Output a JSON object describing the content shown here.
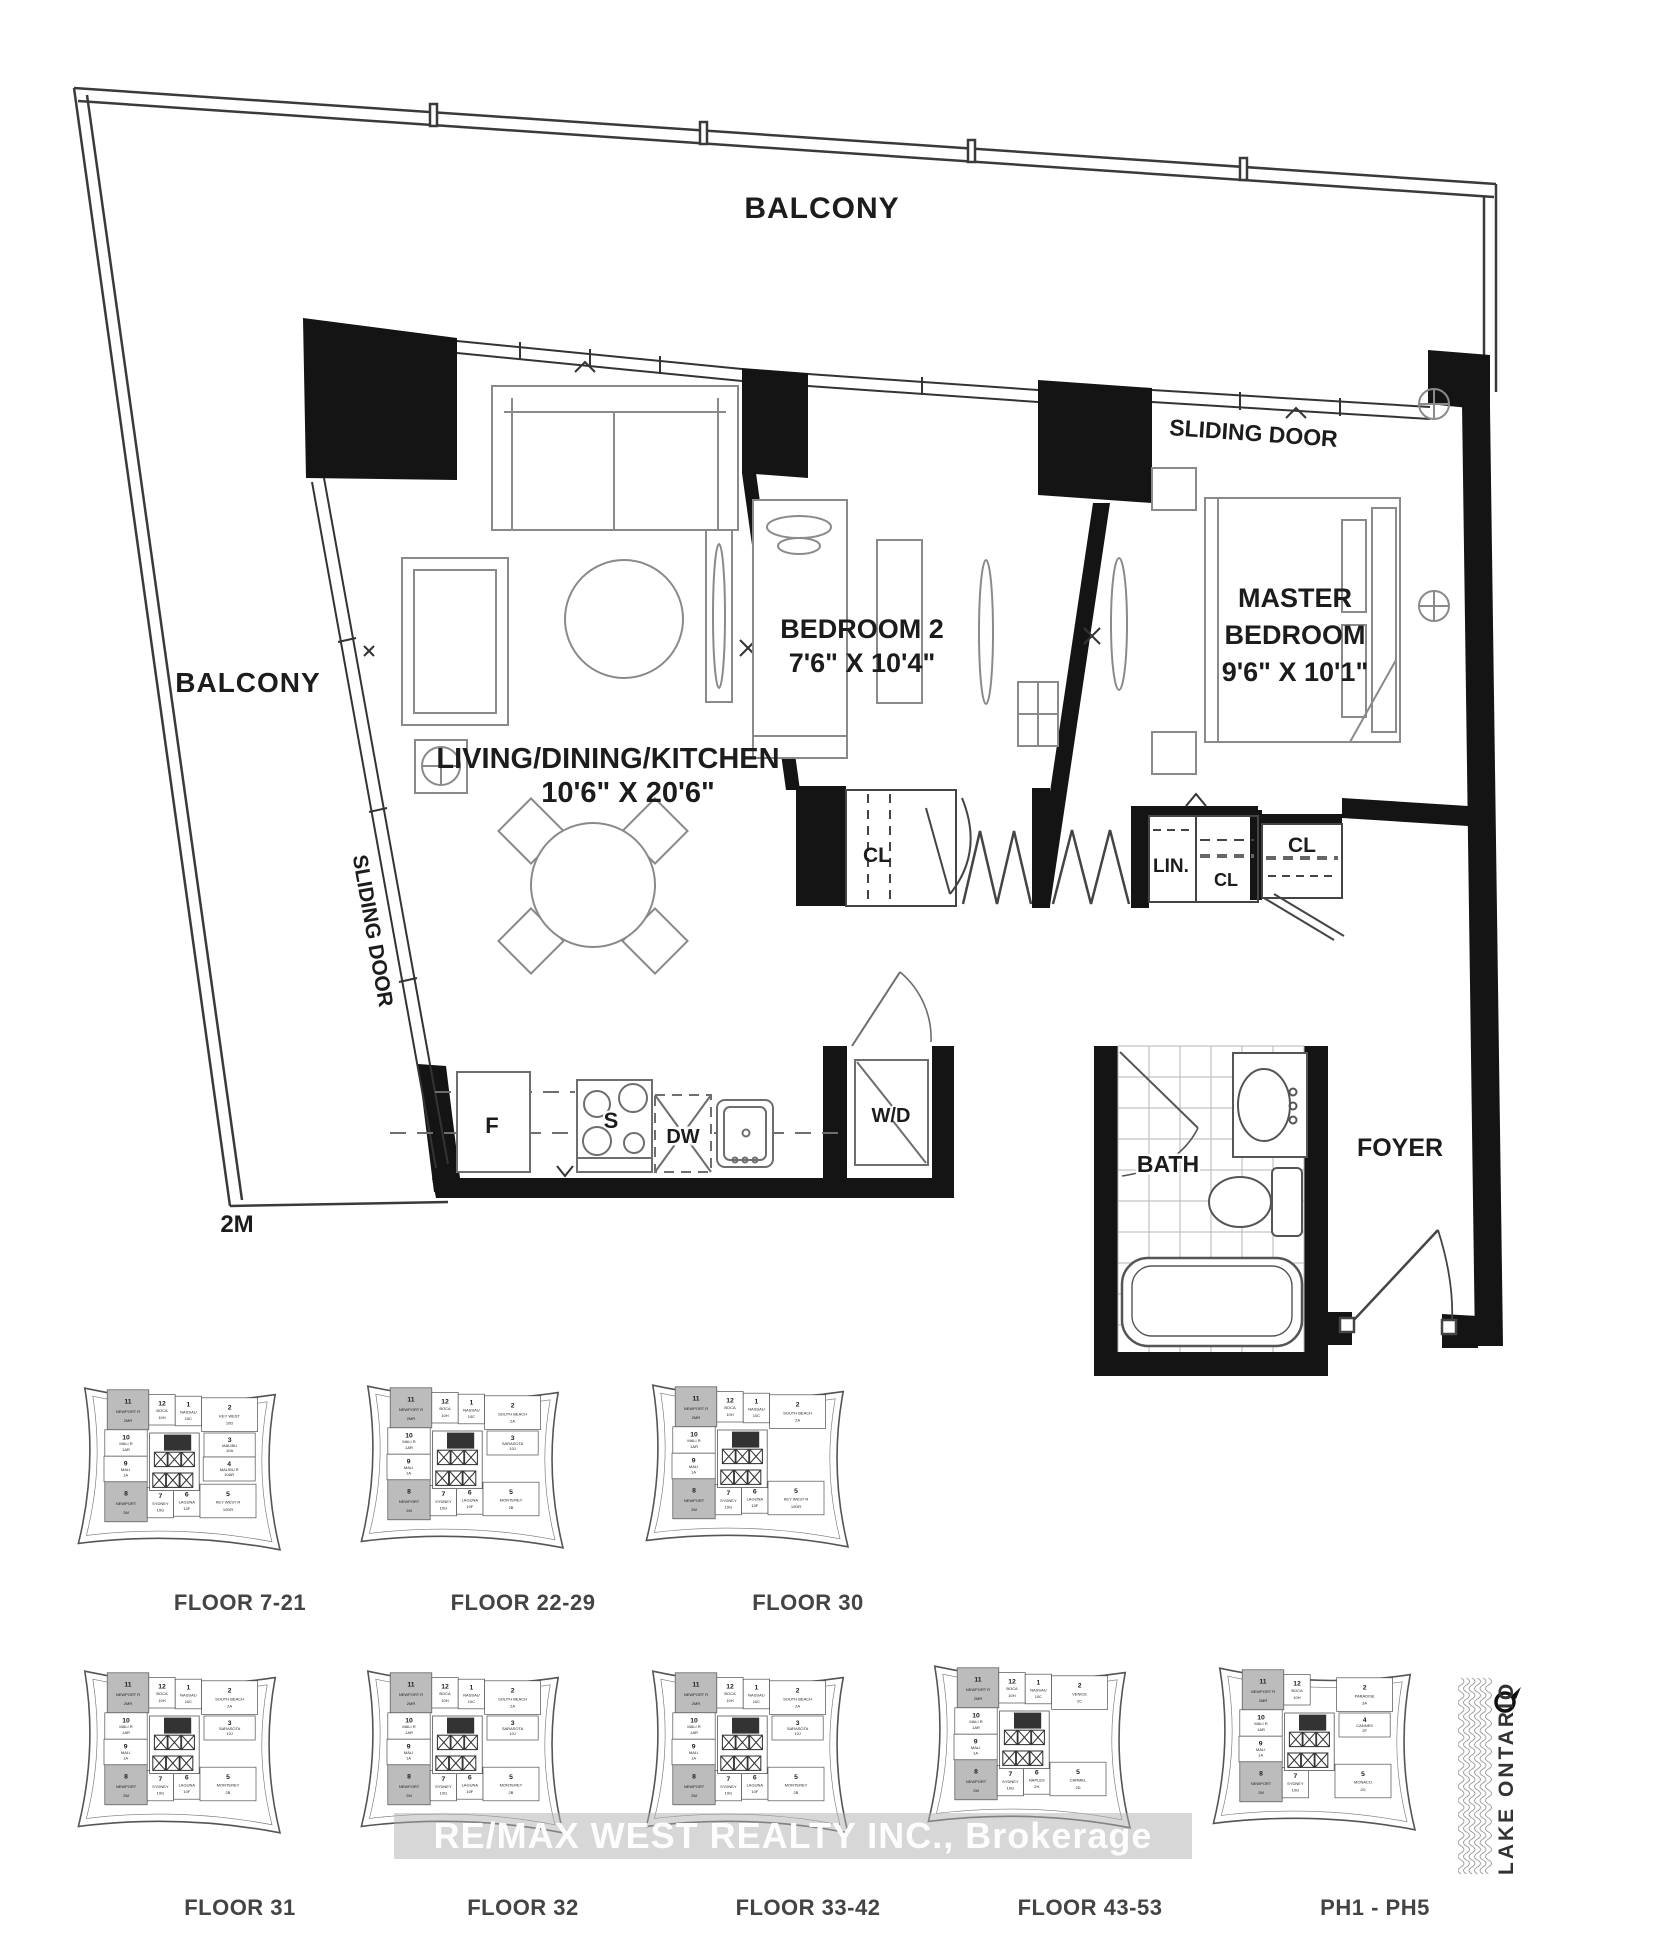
{
  "plan": {
    "balcony_top": "BALCONY",
    "balcony_left": "BALCONY",
    "sliding_door_top": "SLIDING DOOR",
    "sliding_door_left": "SLIDING DOOR",
    "living": {
      "title": "LIVING/DINING/KITCHEN",
      "dims": "10'6\" X 20'6\""
    },
    "bedroom2": {
      "title": "BEDROOM 2",
      "dims": "7'6\" X 10'4\""
    },
    "master": {
      "line1": "MASTER",
      "line2": "BEDROOM",
      "dims": "9'6\" X 10'1\""
    },
    "closets": {
      "bedroom2": "CL",
      "linen": "LIN.",
      "linen_cl": "CL",
      "master": "CL"
    },
    "kitchen": {
      "fridge": "F",
      "stove": "S",
      "dishwasher": "DW",
      "washer_dryer": "W/D"
    },
    "bath": "BATH",
    "foyer": "FOYER",
    "scale_note": "2M"
  },
  "watermark": {
    "text": "RE/MAX WEST REALTY INC., Brokerage"
  },
  "lake": {
    "label": "LAKE ONTARIO"
  },
  "keyplates": [
    {
      "floor_label": "FLOOR 7-21",
      "units": [
        {
          "no": "11",
          "name": "NEWPORT R",
          "code": "2MR",
          "slot": "tl",
          "hl": true
        },
        {
          "no": "12",
          "name": "BOCA",
          "code": "10H",
          "slot": "t1"
        },
        {
          "no": "1",
          "name": "NASSAU",
          "code": "10C",
          "slot": "t2"
        },
        {
          "no": "2",
          "name": "KEY WEST",
          "code": "10D",
          "slot": "tr"
        },
        {
          "no": "10",
          "name": "MALI R",
          "code": "1AR",
          "slot": "l1"
        },
        {
          "no": "3",
          "name": "MALIBU",
          "code": "10A",
          "slot": "r1"
        },
        {
          "no": "9",
          "name": "MALI",
          "code": "1A",
          "slot": "l2"
        },
        {
          "no": "4",
          "name": "MALIBU R",
          "code": "10AR",
          "slot": "r2"
        },
        {
          "no": "8",
          "name": "NEWPORT",
          "code": "2M",
          "slot": "bl",
          "hl": true
        },
        {
          "no": "7",
          "name": "SYDNEY",
          "code": "10G",
          "slot": "b1"
        },
        {
          "no": "6",
          "name": "LAGUNA",
          "code": "10F",
          "slot": "b2"
        },
        {
          "no": "5",
          "name": "KEY WEST R",
          "code": "10DR",
          "slot": "br"
        }
      ]
    },
    {
      "floor_label": "FLOOR 22-29",
      "units": [
        {
          "no": "11",
          "name": "NEWPORT R",
          "code": "2MR",
          "slot": "tl",
          "hl": true
        },
        {
          "no": "12",
          "name": "BOCA",
          "code": "10H",
          "slot": "t1"
        },
        {
          "no": "1",
          "name": "NASSAU",
          "code": "10C",
          "slot": "t2"
        },
        {
          "no": "2",
          "name": "SOUTH BEACH",
          "code": "2A",
          "slot": "tr"
        },
        {
          "no": "10",
          "name": "MALI R",
          "code": "1AR",
          "slot": "l1"
        },
        {
          "no": "3",
          "name": "SARASOTA",
          "code": "10J",
          "slot": "r1"
        },
        {
          "no": "9",
          "name": "MALI",
          "code": "1A",
          "slot": "l2"
        },
        {
          "no": "8",
          "name": "NEWPORT",
          "code": "2M",
          "slot": "bl",
          "hl": true
        },
        {
          "no": "7",
          "name": "SYDNEY",
          "code": "10G",
          "slot": "b1"
        },
        {
          "no": "6",
          "name": "LAGUNA",
          "code": "10F",
          "slot": "b2"
        },
        {
          "no": "5",
          "name": "MONTEREY",
          "code": "2B",
          "slot": "br"
        }
      ]
    },
    {
      "floor_label": "FLOOR 30",
      "units": [
        {
          "no": "11",
          "name": "NEWPORT R",
          "code": "2MR",
          "slot": "tl",
          "hl": true
        },
        {
          "no": "12",
          "name": "BOCA",
          "code": "10H",
          "slot": "t1"
        },
        {
          "no": "1",
          "name": "NASSAU",
          "code": "10C",
          "slot": "t2"
        },
        {
          "no": "2",
          "name": "SOUTH BEACH",
          "code": "2A",
          "slot": "tr"
        },
        {
          "no": "10",
          "name": "MALI R",
          "code": "1AR",
          "slot": "l1"
        },
        {
          "no": "9",
          "name": "MALI",
          "code": "1A",
          "slot": "l2"
        },
        {
          "no": "8",
          "name": "NEWPORT",
          "code": "2M",
          "slot": "bl",
          "hl": true
        },
        {
          "no": "7",
          "name": "SYDNEY",
          "code": "10G",
          "slot": "b1"
        },
        {
          "no": "6",
          "name": "LAGUNA",
          "code": "10F",
          "slot": "b2"
        },
        {
          "no": "5",
          "name": "KEY WEST R",
          "code": "10DR",
          "slot": "br"
        }
      ]
    },
    {
      "floor_label": "FLOOR 31",
      "units": [
        {
          "no": "11",
          "name": "NEWPORT R",
          "code": "2MR",
          "slot": "tl",
          "hl": true
        },
        {
          "no": "12",
          "name": "BOCA",
          "code": "10H",
          "slot": "t1"
        },
        {
          "no": "1",
          "name": "NASSAU",
          "code": "10C",
          "slot": "t2"
        },
        {
          "no": "2",
          "name": "SOUTH BEACH",
          "code": "2A",
          "slot": "tr"
        },
        {
          "no": "10",
          "name": "MALI R",
          "code": "1AR",
          "slot": "l1"
        },
        {
          "no": "3",
          "name": "SARASOTA",
          "code": "10J",
          "slot": "r1"
        },
        {
          "no": "9",
          "name": "MALI",
          "code": "1A",
          "slot": "l2"
        },
        {
          "no": "8",
          "name": "NEWPORT",
          "code": "2M",
          "slot": "bl",
          "hl": true
        },
        {
          "no": "7",
          "name": "SYDNEY",
          "code": "10G",
          "slot": "b1"
        },
        {
          "no": "6",
          "name": "LAGUNA",
          "code": "10F",
          "slot": "b2"
        },
        {
          "no": "5",
          "name": "MONTEREY",
          "code": "2B",
          "slot": "br"
        }
      ]
    },
    {
      "floor_label": "FLOOR 32",
      "units": [
        {
          "no": "11",
          "name": "NEWPORT R",
          "code": "2MR",
          "slot": "tl",
          "hl": true
        },
        {
          "no": "12",
          "name": "BOCA",
          "code": "10H",
          "slot": "t1"
        },
        {
          "no": "1",
          "name": "NASSAU",
          "code": "10C",
          "slot": "t2"
        },
        {
          "no": "2",
          "name": "SOUTH BEACH",
          "code": "2A",
          "slot": "tr"
        },
        {
          "no": "10",
          "name": "MALI R",
          "code": "1AR",
          "slot": "l1"
        },
        {
          "no": "3",
          "name": "SARASOTA",
          "code": "10J",
          "slot": "r1"
        },
        {
          "no": "9",
          "name": "MALI",
          "code": "1A",
          "slot": "l2"
        },
        {
          "no": "8",
          "name": "NEWPORT",
          "code": "2M",
          "slot": "bl",
          "hl": true
        },
        {
          "no": "7",
          "name": "SYDNEY",
          "code": "10G",
          "slot": "b1"
        },
        {
          "no": "6",
          "name": "LAGUNA",
          "code": "10F",
          "slot": "b2"
        },
        {
          "no": "5",
          "name": "MONTEREY",
          "code": "2B",
          "slot": "br"
        }
      ]
    },
    {
      "floor_label": "FLOOR 33-42",
      "units": [
        {
          "no": "11",
          "name": "NEWPORT R",
          "code": "2MR",
          "slot": "tl",
          "hl": true
        },
        {
          "no": "12",
          "name": "BOCA",
          "code": "10H",
          "slot": "t1"
        },
        {
          "no": "1",
          "name": "NASSAU",
          "code": "10C",
          "slot": "t2"
        },
        {
          "no": "2",
          "name": "SOUTH BEACH",
          "code": "2A",
          "slot": "tr"
        },
        {
          "no": "10",
          "name": "MALI R",
          "code": "1AR",
          "slot": "l1"
        },
        {
          "no": "3",
          "name": "SARASOTA",
          "code": "10J",
          "slot": "r1"
        },
        {
          "no": "9",
          "name": "MALI",
          "code": "1A",
          "slot": "l2"
        },
        {
          "no": "8",
          "name": "NEWPORT",
          "code": "2M",
          "slot": "bl",
          "hl": true
        },
        {
          "no": "7",
          "name": "SYDNEY",
          "code": "10G",
          "slot": "b1"
        },
        {
          "no": "6",
          "name": "LAGUNA",
          "code": "10F",
          "slot": "b2"
        },
        {
          "no": "5",
          "name": "MONTEREY",
          "code": "2B",
          "slot": "br"
        }
      ]
    },
    {
      "floor_label": "FLOOR 43-53",
      "units": [
        {
          "no": "11",
          "name": "NEWPORT R",
          "code": "2MR",
          "slot": "tl",
          "hl": true
        },
        {
          "no": "12",
          "name": "BOCA",
          "code": "10H",
          "slot": "t1"
        },
        {
          "no": "1",
          "name": "NASSAU",
          "code": "10C",
          "slot": "t2"
        },
        {
          "no": "2",
          "name": "VENICE",
          "code": "2C",
          "slot": "tr"
        },
        {
          "no": "10",
          "name": "MALI R",
          "code": "1AR",
          "slot": "l1"
        },
        {
          "no": "9",
          "name": "MALI",
          "code": "1A",
          "slot": "l2"
        },
        {
          "no": "8",
          "name": "NEWPORT",
          "code": "2M",
          "slot": "bl",
          "hl": true
        },
        {
          "no": "7",
          "name": "SYDNEY",
          "code": "10G",
          "slot": "b1"
        },
        {
          "no": "6",
          "name": "NAPLES",
          "code": "2H",
          "slot": "b2"
        },
        {
          "no": "5",
          "name": "CARMEL",
          "code": "2D",
          "slot": "br"
        }
      ]
    },
    {
      "floor_label": "PH1 - PH5",
      "units": [
        {
          "no": "11",
          "name": "NEWPORT R",
          "code": "2MR",
          "slot": "tl",
          "hl": true
        },
        {
          "no": "12",
          "name": "BOCA",
          "code": "10H",
          "slot": "t1"
        },
        {
          "no": "2",
          "name": "PARADISE",
          "code": "3A",
          "slot": "tr"
        },
        {
          "no": "10",
          "name": "MALI R",
          "code": "1AR",
          "slot": "l1"
        },
        {
          "no": "4",
          "name": "CANNES",
          "code": "2F",
          "slot": "r1"
        },
        {
          "no": "9",
          "name": "MALI",
          "code": "1A",
          "slot": "l2"
        },
        {
          "no": "8",
          "name": "NEWPORT",
          "code": "2M",
          "slot": "bl",
          "hl": true
        },
        {
          "no": "7",
          "name": "SYDNEY",
          "code": "10G",
          "slot": "b1"
        },
        {
          "no": "5",
          "name": "MONACO",
          "code": "2G",
          "slot": "br"
        }
      ]
    }
  ]
}
